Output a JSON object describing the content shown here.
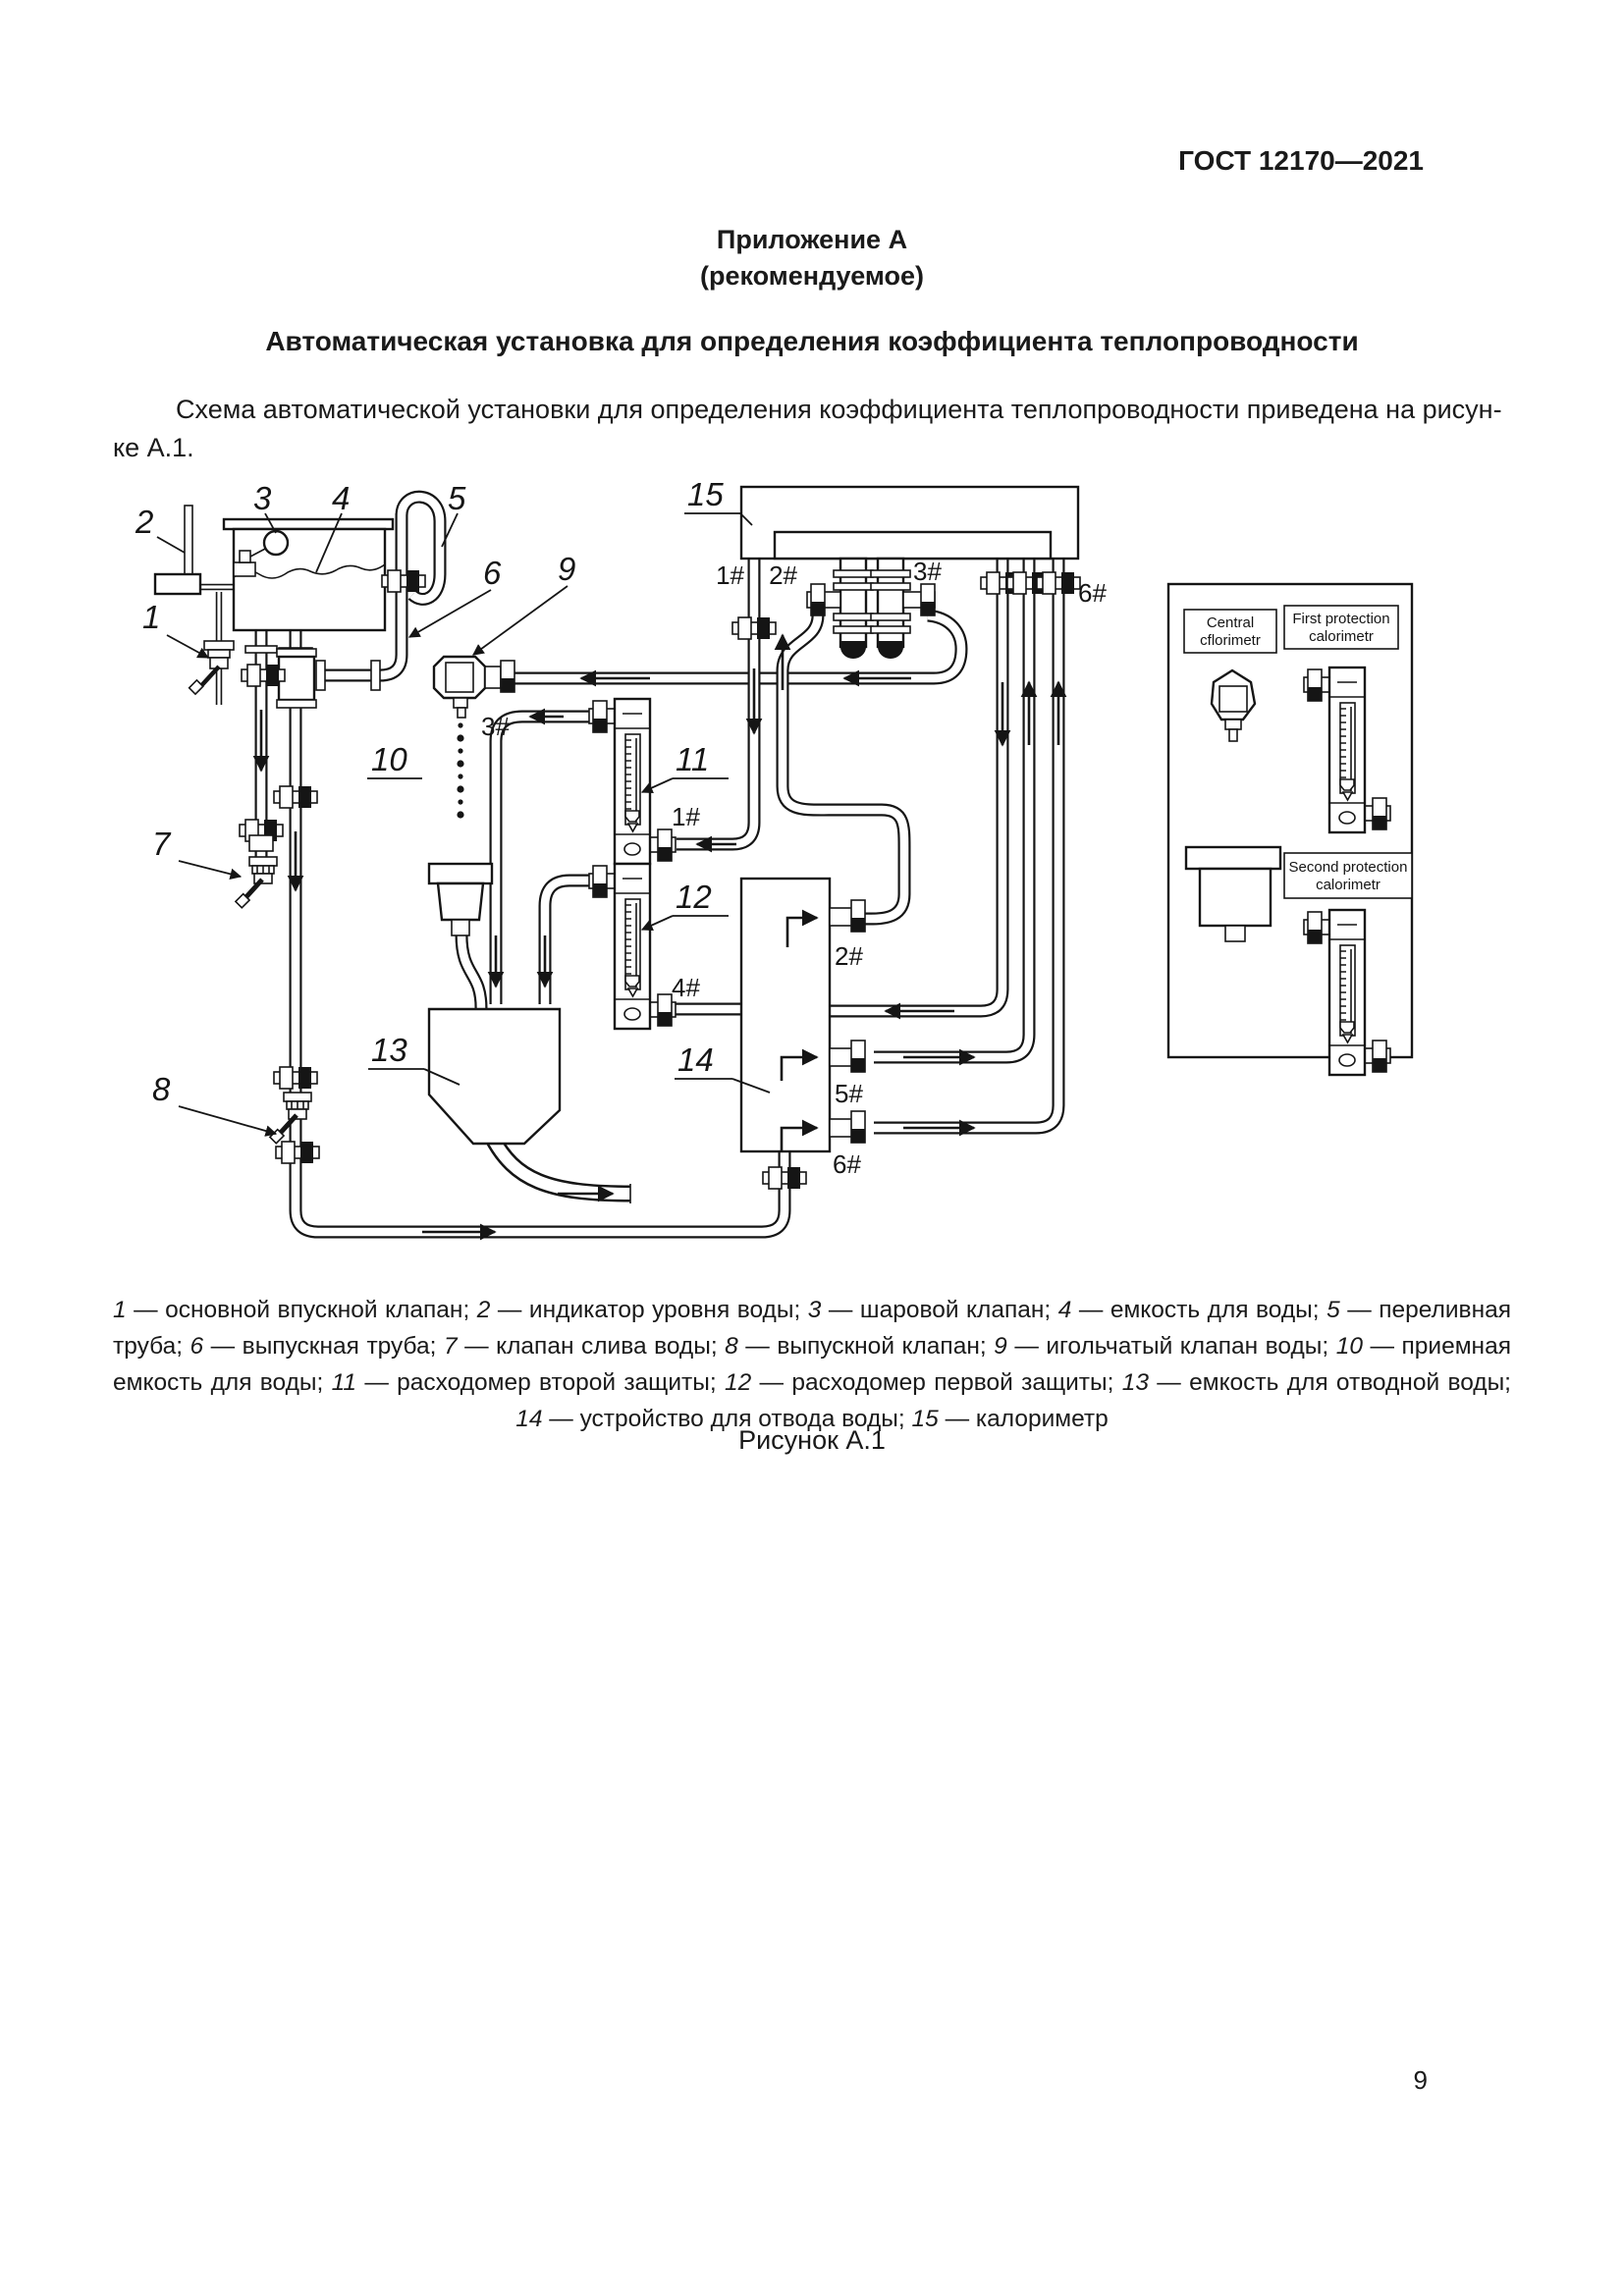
{
  "page": {
    "header": "ГОСТ 12170—2021",
    "appendix_line1": "Приложение А",
    "appendix_line2": "(рекомендуемое)",
    "title": "Автоматическая установка для определения коэффициента теплопроводности",
    "body_line1": "Схема автоматической установки для определения коэффициента теплопроводности приведена на рисун-",
    "body_line2": "ке А.1.",
    "figure_label": "Рисунок А.1",
    "page_number": "9"
  },
  "diagram": {
    "part_labels": [
      "1",
      "2",
      "3",
      "4",
      "5",
      "6",
      "7",
      "8",
      "9",
      "10",
      "11",
      "12",
      "13",
      "14",
      "15"
    ],
    "ports": {
      "cal1": "1#",
      "cal2": "2#",
      "cal3": "3#",
      "cal6": "6#",
      "needle3": "3#",
      "fm11": "1#",
      "fm12": "4#",
      "dev2": "2#",
      "dev5": "5#",
      "dev6": "6#"
    },
    "legend": {
      "central1": "Central",
      "central2": "cflorimetr",
      "first1": "First protection",
      "first2": "calorimetr",
      "second1": "Second protection",
      "second2": "calorimetr"
    }
  },
  "caption": {
    "items": [
      {
        "n": "1",
        "t": "основной впускной клапан"
      },
      {
        "n": "2",
        "t": "индикатор уровня воды"
      },
      {
        "n": "3",
        "t": "шаровой клапан"
      },
      {
        "n": "4",
        "t": "емкость для воды"
      },
      {
        "n": "5",
        "t": "переливная труба"
      },
      {
        "n": "6",
        "t": "выпускная труба"
      },
      {
        "n": "7",
        "t": "клапан слива воды"
      },
      {
        "n": "8",
        "t": "выпускной клапан"
      },
      {
        "n": "9",
        "t": "игольчатый клапан воды"
      },
      {
        "n": "10",
        "t": "приемная емкость для воды"
      },
      {
        "n": "11",
        "t": "расходомер второй защиты"
      },
      {
        "n": "12",
        "t": "расходомер первой защиты"
      },
      {
        "n": "13",
        "t": "емкость для отводной воды"
      },
      {
        "n": "14",
        "t": "устройство для отвода воды"
      },
      {
        "n": "15",
        "t": "калориметр"
      }
    ]
  }
}
